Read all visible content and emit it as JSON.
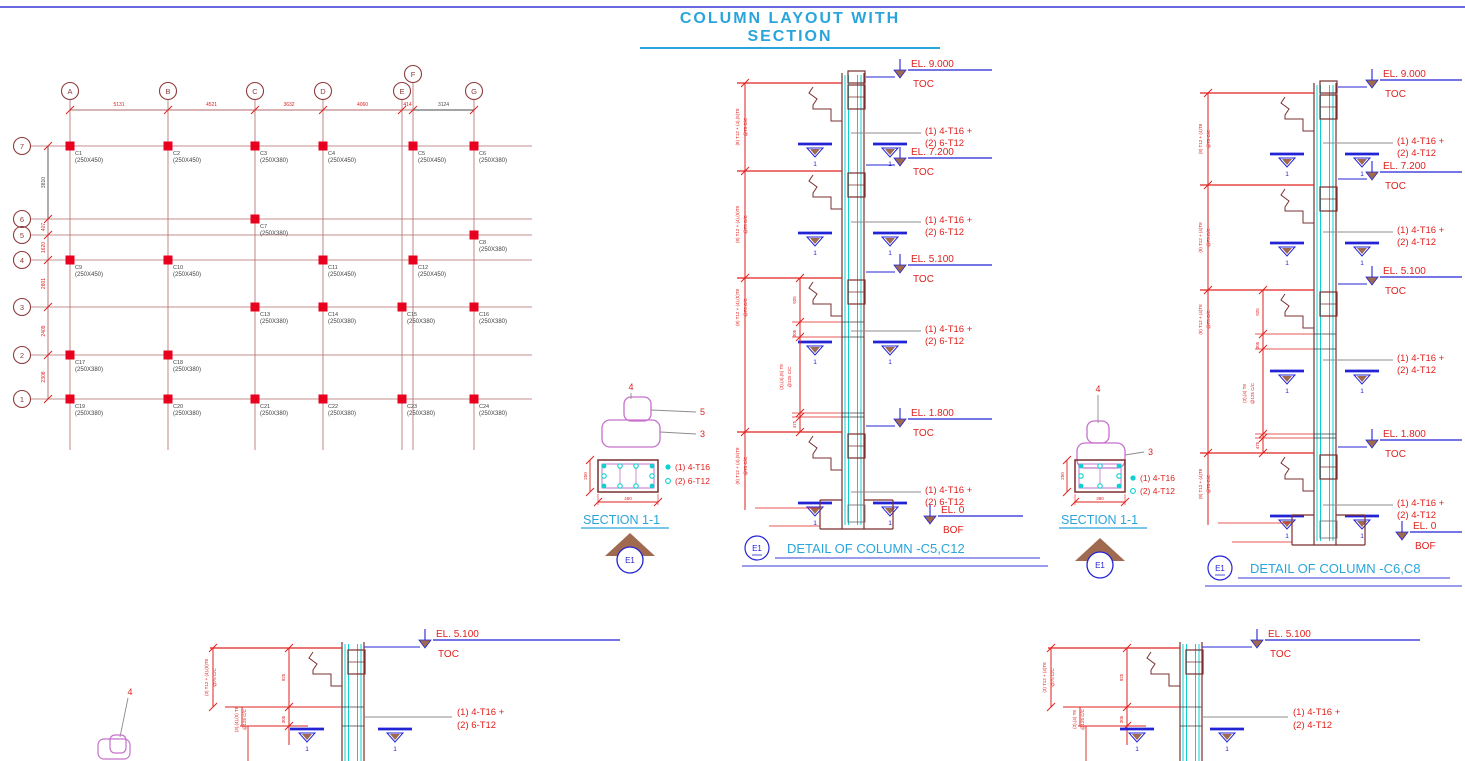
{
  "title": "COLUMN LAYOUT WITH SECTION",
  "plan": {
    "col_axes": [
      "A",
      "B",
      "C",
      "D",
      "E",
      "F",
      "G"
    ],
    "col_dims": [
      "5131",
      "4521",
      "3632",
      "4060",
      "414",
      "3124"
    ],
    "row_axes": [
      "7",
      "6",
      "5",
      "4",
      "3",
      "2",
      "1"
    ],
    "row_dims": [
      "3810",
      "407",
      "1620",
      "2801",
      "2409",
      "2308"
    ],
    "columns": [
      {
        "name": "C1",
        "size": "(250X450)",
        "col": "A",
        "row": "7"
      },
      {
        "name": "C2",
        "size": "(250X450)",
        "col": "B",
        "row": "7"
      },
      {
        "name": "C3",
        "size": "(250X380)",
        "col": "C",
        "row": "7"
      },
      {
        "name": "C4",
        "size": "(250X450)",
        "col": "D",
        "row": "7"
      },
      {
        "name": "C5",
        "size": "(250X450)",
        "col": "F",
        "row": "7"
      },
      {
        "name": "C6",
        "size": "(250X380)",
        "col": "G",
        "row": "7"
      },
      {
        "name": "C7",
        "size": "(250X380)",
        "col": "C",
        "row": "6"
      },
      {
        "name": "C8",
        "size": "(250X380)",
        "col": "G",
        "row": "5"
      },
      {
        "name": "C9",
        "size": "(250X450)",
        "col": "A",
        "row": "4"
      },
      {
        "name": "C10",
        "size": "(250X450)",
        "col": "B",
        "row": "4"
      },
      {
        "name": "C11",
        "size": "(250X450)",
        "col": "D",
        "row": "4"
      },
      {
        "name": "C12",
        "size": "(250X450)",
        "col": "F",
        "row": "4"
      },
      {
        "name": "C13",
        "size": "(250X380)",
        "col": "C",
        "row": "3"
      },
      {
        "name": "C14",
        "size": "(250X380)",
        "col": "D",
        "row": "3"
      },
      {
        "name": "C15",
        "size": "(250X380)",
        "col": "E",
        "row": "3"
      },
      {
        "name": "C16",
        "size": "(250X380)",
        "col": "G",
        "row": "3"
      },
      {
        "name": "C17",
        "size": "(250X380)",
        "col": "A",
        "row": "2"
      },
      {
        "name": "C18",
        "size": "(250X380)",
        "col": "B",
        "row": "2"
      },
      {
        "name": "C19",
        "size": "(250X380)",
        "col": "A",
        "row": "1"
      },
      {
        "name": "C20",
        "size": "(250X380)",
        "col": "B",
        "row": "1"
      },
      {
        "name": "C21",
        "size": "(250X380)",
        "col": "C",
        "row": "1"
      },
      {
        "name": "C22",
        "size": "(250X380)",
        "col": "D",
        "row": "1"
      },
      {
        "name": "C23",
        "size": "(250X380)",
        "col": "E",
        "row": "1"
      },
      {
        "name": "C24",
        "size": "(250X380)",
        "col": "G",
        "row": "1"
      }
    ]
  },
  "sections": {
    "left": {
      "title": "SECTION 1-1",
      "marker": "E1",
      "legend": [
        {
          "symbol": "filled-dot",
          "label": "(1) 4-T16"
        },
        {
          "symbol": "hollow-dot",
          "label": "(2) 6-T12"
        }
      ],
      "width_dim": "450",
      "height_dim": "250",
      "callout_top": "4",
      "callout_mid": "5",
      "callout_bot": "3"
    },
    "right": {
      "title": "SECTION 1-1",
      "marker": "E1",
      "legend": [
        {
          "symbol": "filled-dot",
          "label": "(1) 4-T16"
        },
        {
          "symbol": "hollow-dot",
          "label": "(2) 4-T12"
        }
      ],
      "width_dim": "380",
      "height_dim": "250",
      "callout_top": "4",
      "callout_bot": "3"
    }
  },
  "details": {
    "left": {
      "title": "DETAIL OF COLUMN -C5,C12",
      "marker": "E1",
      "levels": [
        {
          "el": "EL. 9.000",
          "ref": "TOC"
        },
        {
          "el": "EL. 7.200",
          "ref": "TOC"
        },
        {
          "el": "EL. 5.100",
          "ref": "TOC"
        },
        {
          "el": "EL. 1.800",
          "ref": "TOC"
        }
      ],
      "base": {
        "el": "EL. 0",
        "ref": "BOF"
      },
      "rebar": [
        "(1) 4-T16 +",
        "(2) 6-T12"
      ],
      "tie_note": [
        "(8) T12 + (4),(5)T8",
        "@75 C/C"
      ],
      "splice_note": [
        "(3),(4),(5) T8",
        "@125 C/C"
      ],
      "story_dims": [
        "925",
        "305",
        "475"
      ],
      "cut_label": "1"
    },
    "right": {
      "title": "DETAIL OF COLUMN -C6,C8",
      "marker": "E1",
      "levels": [
        {
          "el": "EL. 9.000",
          "ref": "TOC"
        },
        {
          "el": "EL. 7.200",
          "ref": "TOC"
        },
        {
          "el": "EL. 5.100",
          "ref": "TOC"
        },
        {
          "el": "EL. 1.800",
          "ref": "TOC"
        }
      ],
      "base": {
        "el": "EL. 0",
        "ref": "BOF"
      },
      "rebar": [
        "(1) 4-T16 +",
        "(2) 4-T12"
      ],
      "tie_note": [
        "(8) T12 + (4)T8",
        "@75 C/C"
      ],
      "splice_note": [
        "(3),(4) T8",
        "@125 C/C"
      ],
      "story_dims": [
        "925",
        "305",
        "475"
      ],
      "cut_label": "1"
    }
  },
  "partials": {
    "left": {
      "el": "EL. 5.100",
      "ref": "TOC",
      "rebar": [
        "(1) 4-T16 +",
        "(2) 6-T12"
      ],
      "tie_note": [
        "(3) T12 + (4),(5)T8",
        "@75 C/C"
      ],
      "splice_note": [
        "(3),(4),(5) T8",
        "@125 C/C"
      ],
      "dims": [
        "925",
        "305"
      ],
      "cut_label": "1",
      "callout": "4"
    },
    "right": {
      "el": "EL. 5.100",
      "ref": "TOC",
      "rebar": [
        "(1) 4-T16 +",
        "(2) 4-T12"
      ],
      "tie_note": [
        "(3) T12 + (4)T8",
        "@75 C/C"
      ],
      "splice_note": [
        "(3),(4) T8",
        "@125 C/C"
      ],
      "dims": [
        "925",
        "305"
      ],
      "cut_label": "1"
    }
  },
  "colors": {
    "topline": "#6868e0",
    "title": "#2aa5dc",
    "red": "#e0201e",
    "column_red": "#e8001e",
    "maroon": "#8e3b3b",
    "grid": "#b06a6a",
    "outline": "#7a2f2f",
    "blue": "#2323d6",
    "violet": "#6060e0",
    "rebar_cyan": "#0fd0d0",
    "magenta": "#c671cc",
    "brown": "#9f6a50",
    "gray": "#8c8c8c",
    "dark": "#3f3f3f",
    "dim_dark": "#4a4a4a"
  }
}
